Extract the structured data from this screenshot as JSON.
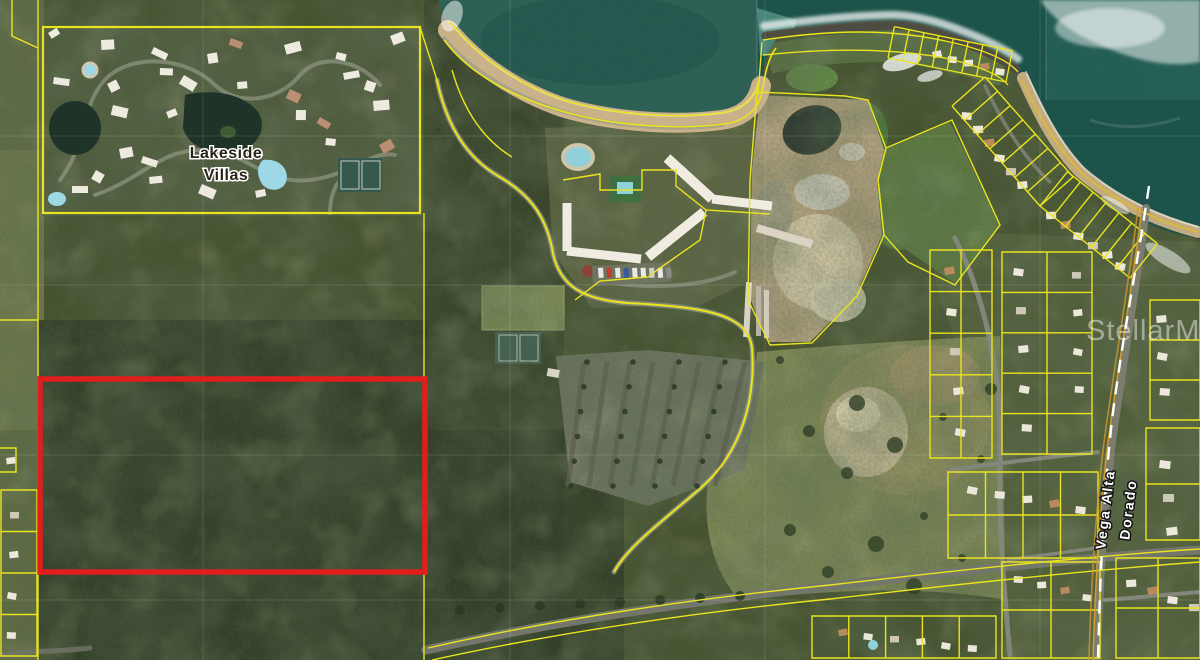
{
  "map": {
    "type": "satellite-parcel-map",
    "labels": {
      "development_line1": "Lakeside",
      "development_line2": "Villas",
      "municipality_left": "Vega Alta",
      "municipality_right": "Dorado",
      "watermark": "StellarMLS"
    },
    "colors": {
      "parcel_line": "#e9e41f",
      "subject_outline": "#e11e1e",
      "municipal_dash": "#ffffff",
      "road_centerline": "#cf9a2e",
      "ocean": "#0c4843",
      "cove_water": "#2d6156",
      "beach_sand": "#c9b28a",
      "vegetation": "#46522f"
    }
  }
}
